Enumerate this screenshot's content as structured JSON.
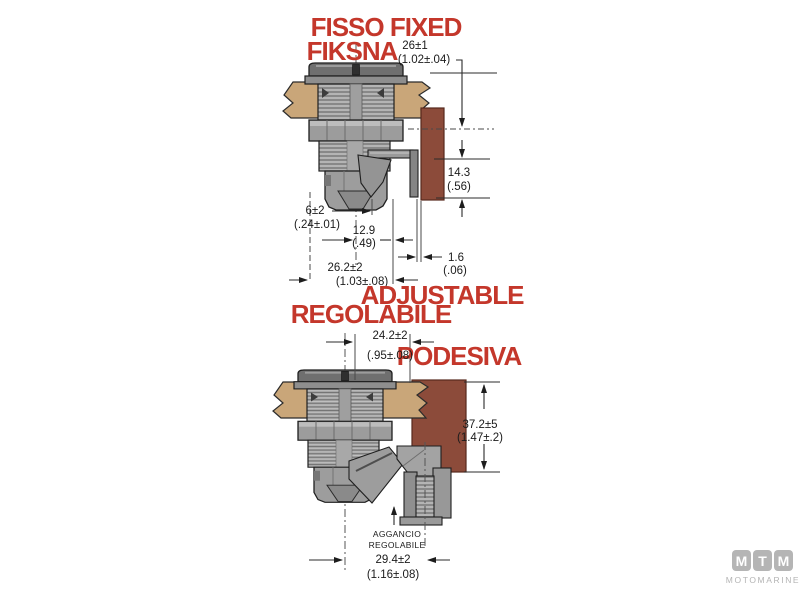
{
  "colors": {
    "red_label": "#c4372b",
    "panel_tan": "#c9a679",
    "bracket_brown": "#8c4b3a",
    "metal_gray": "#a4a4a4"
  },
  "fixed": {
    "title_line1": "FISSO FIXED",
    "title_line2": "FIKSNA",
    "dims": {
      "hole": {
        "mm": "26±1",
        "in": "(1.02±.04)"
      },
      "bracket_height": {
        "mm": "14.3",
        "in": "(.56)"
      },
      "panel_clearance": {
        "mm": "6±2",
        "in": "(.24±.01)"
      },
      "latch_reach": {
        "mm": "12.9",
        "in": "(.49)"
      },
      "gap": {
        "mm": "1.6",
        "in": "(.06)"
      },
      "overall_depth": {
        "mm": "26.2±2",
        "in": "(1.03±.08)"
      }
    }
  },
  "adjustable": {
    "title_en": "ADJUSTABLE",
    "title_it": "REGOLABILE",
    "title_hr": "PODESIVA",
    "hook_note_line1": "AGGANCIO",
    "hook_note_line2": "REGOLABILE",
    "dims": {
      "offset": {
        "mm": "24.2±2",
        "in": "(.95±.08)"
      },
      "bracket_height": {
        "mm": "37.2±5",
        "in": "(1.47±.2)"
      },
      "overall_depth": {
        "mm": "29.4±2",
        "in": "(1.16±.08)"
      }
    }
  },
  "logo": {
    "letters": [
      "M",
      "T",
      "M"
    ],
    "name": "MOTOMARINE"
  }
}
